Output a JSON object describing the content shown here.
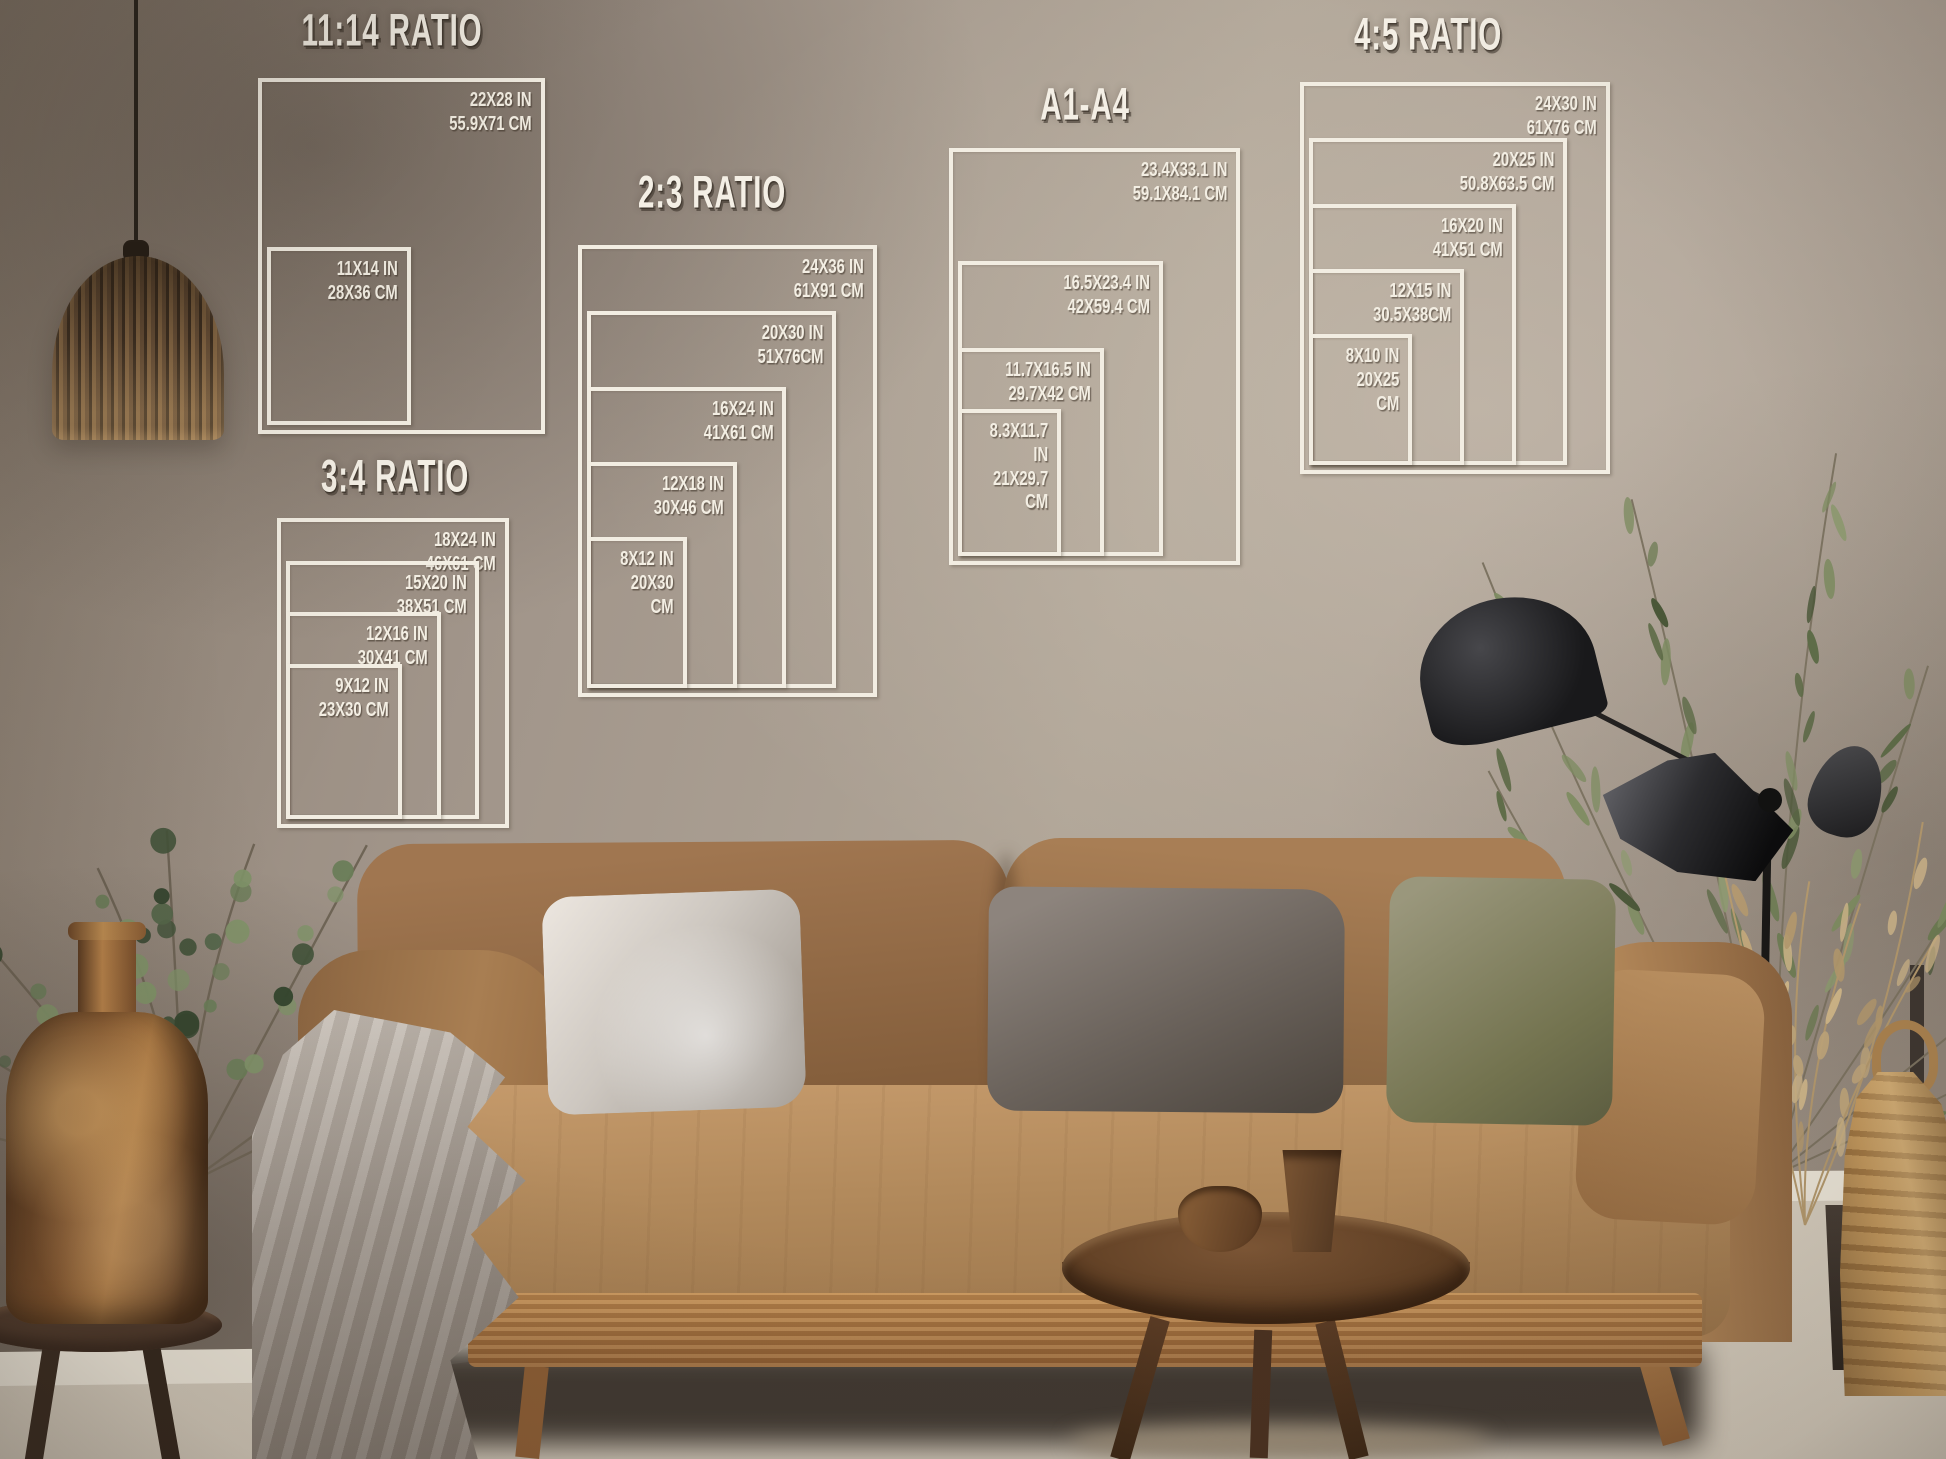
{
  "overlay": {
    "line_color": "#f2ede2",
    "text_color": "#f4efe5",
    "blocks": [
      {
        "title": "11:14 RATIO",
        "title_cx": 392,
        "title_y": 6,
        "box_px": {
          "left": 258,
          "top": 78,
          "width": 287,
          "height": 356
        },
        "sizes": [
          {
            "w_in": 22,
            "h_in": 28,
            "inches": "22X28 IN",
            "cm": "55.9X71 CM"
          },
          {
            "w_in": 11,
            "h_in": 14,
            "inches": "11X14 IN",
            "cm": "28X36 CM"
          }
        ]
      },
      {
        "title": "3:4 RATIO",
        "title_cx": 395,
        "title_y": 452,
        "box_px": {
          "left": 277,
          "top": 518,
          "width": 232,
          "height": 310
        },
        "sizes": [
          {
            "w_in": 18,
            "h_in": 24,
            "inches": "18X24 IN",
            "cm": "46X61 CM"
          },
          {
            "w_in": 15,
            "h_in": 20,
            "inches": "15X20 IN",
            "cm": "38X51 CM"
          },
          {
            "w_in": 12,
            "h_in": 16,
            "inches": "12X16 IN",
            "cm": "30X41 CM"
          },
          {
            "w_in": 9,
            "h_in": 12,
            "inches": "9X12 IN",
            "cm": "23X30 CM"
          }
        ]
      },
      {
        "title": "2:3 RATIO",
        "title_cx": 712,
        "title_y": 168,
        "box_px": {
          "left": 578,
          "top": 245,
          "width": 299,
          "height": 452
        },
        "sizes": [
          {
            "w_in": 24,
            "h_in": 36,
            "inches": "24X36 IN",
            "cm": "61X91 CM"
          },
          {
            "w_in": 20,
            "h_in": 30,
            "inches": "20X30 IN",
            "cm": "51X76CM"
          },
          {
            "w_in": 16,
            "h_in": 24,
            "inches": "16X24 IN",
            "cm": "41X61 CM"
          },
          {
            "w_in": 12,
            "h_in": 18,
            "inches": "12X18 IN",
            "cm": "30X46 CM"
          },
          {
            "w_in": 8,
            "h_in": 12,
            "inches": "8X12 IN",
            "cm": "20X30 CM"
          }
        ]
      },
      {
        "title": "A1-A4",
        "title_cx": 1085,
        "title_y": 80,
        "box_px": {
          "left": 949,
          "top": 148,
          "width": 291,
          "height": 417
        },
        "sizes": [
          {
            "w_in": 23.4,
            "h_in": 33.1,
            "inches": "23.4X33.1 IN",
            "cm": "59.1X84.1 CM"
          },
          {
            "w_in": 16.5,
            "h_in": 23.4,
            "inches": "16.5X23.4 IN",
            "cm": "42X59.4 CM"
          },
          {
            "w_in": 11.7,
            "h_in": 16.5,
            "inches": "11.7X16.5 IN",
            "cm": "29.7X42 CM"
          },
          {
            "w_in": 8.3,
            "h_in": 11.7,
            "inches": "8.3X11.7 IN",
            "cm": "21X29.7 CM"
          }
        ]
      },
      {
        "title": "4:5 RATIO",
        "title_cx": 1428,
        "title_y": 10,
        "box_px": {
          "left": 1300,
          "top": 82,
          "width": 310,
          "height": 392
        },
        "sizes": [
          {
            "w_in": 24,
            "h_in": 30,
            "inches": "24X30 IN",
            "cm": "61X76 CM"
          },
          {
            "w_in": 20,
            "h_in": 25,
            "inches": "20X25 IN",
            "cm": "50.8X63.5 CM"
          },
          {
            "w_in": 16,
            "h_in": 20,
            "inches": "16X20 IN",
            "cm": "41X51 CM"
          },
          {
            "w_in": 12,
            "h_in": 15,
            "inches": "12X15 IN",
            "cm": "30.5X38CM"
          },
          {
            "w_in": 8,
            "h_in": 10,
            "inches": "8X10 IN",
            "cm": "20X25 CM"
          }
        ]
      }
    ]
  },
  "scene": {
    "wall_color": "#a59a8c",
    "sofa_color": "#b28a5e",
    "plant_green": "#5f7350",
    "copper": "#a97843",
    "lamp_black": "#1d1c1a",
    "floor_color": "#e6dfd2"
  }
}
